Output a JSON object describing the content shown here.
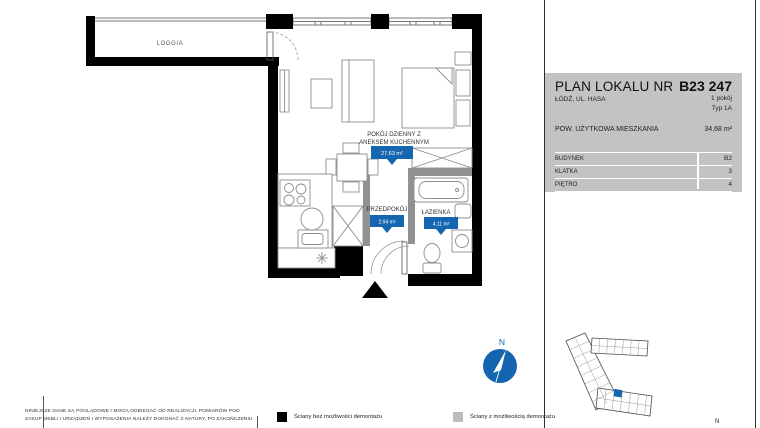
{
  "panel": {
    "title": "PLAN LOKALU NR",
    "unit": "B23 247",
    "address": "ŁÓDŹ, UL. HASA",
    "rooms": "1 pokój",
    "unit_type": "Typ 1A",
    "area_label": "POW. UŻYTKOWA MIESZKANIA",
    "area_value": "34,68 m²",
    "table": [
      {
        "label": "BUDYNEK",
        "value": "B2"
      },
      {
        "label": "KLATKA",
        "value": "3"
      },
      {
        "label": "PIĘTRO",
        "value": "4"
      }
    ]
  },
  "plan": {
    "loggia": {
      "name": "LOGGIA"
    },
    "living": {
      "name_line1": "POKÓJ DZIENNY Z",
      "name_line2": "ANEKSEM KUCHENNYM",
      "area": "27.63 m²"
    },
    "hall": {
      "name": "PRZEDPOKÓJ",
      "area": "2.94 m²"
    },
    "bathroom": {
      "name": "ŁAZIENKA",
      "area": "4.11 m²"
    }
  },
  "compass": {
    "north": "N"
  },
  "minimap": {
    "north": "N"
  },
  "legend": [
    {
      "label": "Ściany bez możliwości demontażu",
      "swatch": "#000000"
    },
    {
      "label": "Ściany z możliwością demontażu",
      "swatch": "#bdbdbd"
    }
  ],
  "disclaimer": [
    "NINIEJSZE DANE SĄ POGLĄDOWE I MOGĄ ODBIEGAĆ OD REALIZACJI. POMIARÓW POD",
    "ZAKUP MEBLI I URZĄDZEŃ I WYPOSAŻENIA NALEŻY DOKONAĆ Z NATURY, PO ZAKOŃCZENIU"
  ],
  "colors": {
    "accent_blue": "#1565b0",
    "compass_blue": "#1464ae",
    "panel_gray": "#c3c3c3",
    "wall_black": "#000000",
    "wall_demountable": "#919191"
  }
}
